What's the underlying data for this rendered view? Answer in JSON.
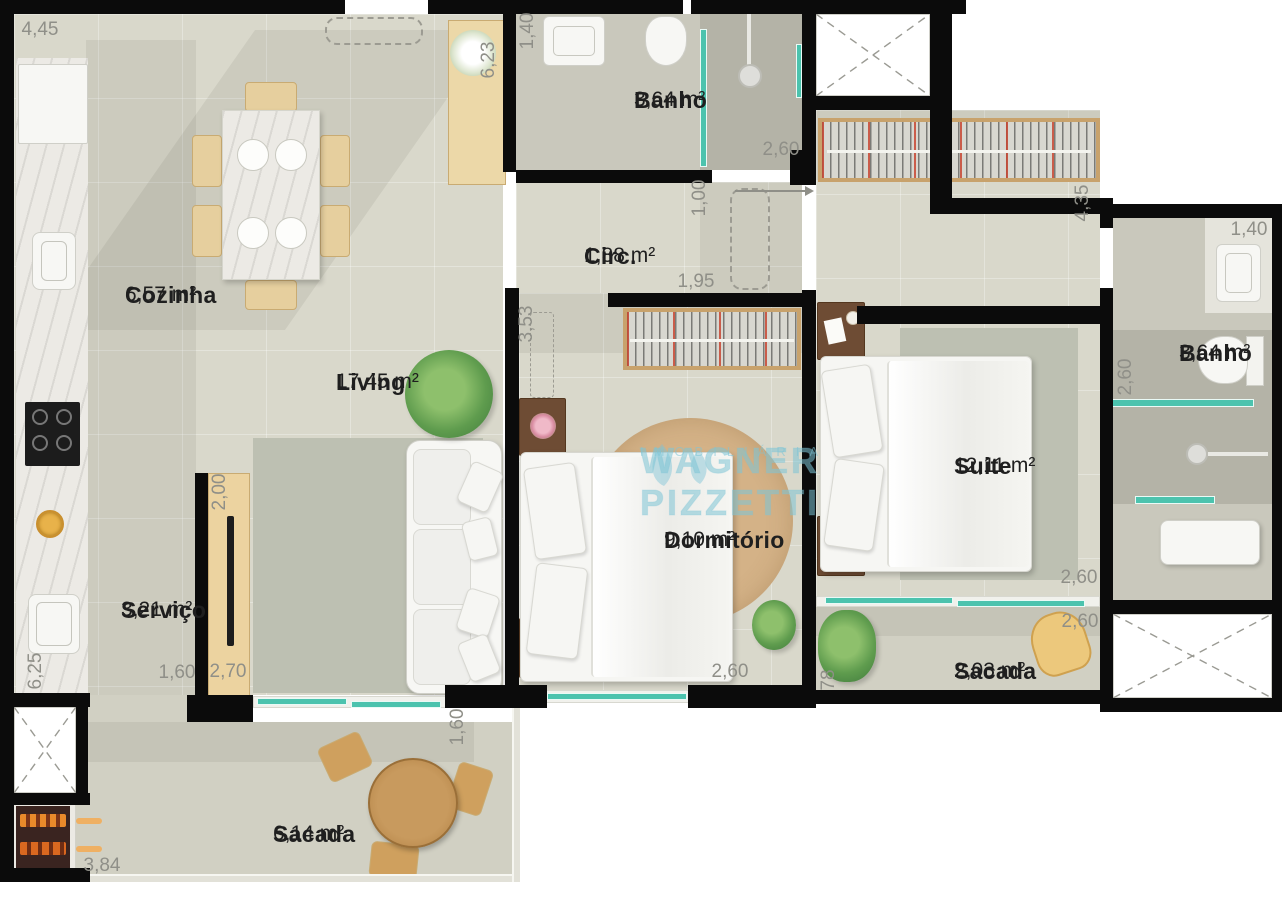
{
  "plan": {
    "type": "apartment-floor-plan",
    "rooms": [
      {
        "id": "cozinha",
        "name": "Cozinha",
        "area": "6,57 m²"
      },
      {
        "id": "banho-social",
        "name": "Banho",
        "area": "3,64 m²"
      },
      {
        "id": "circulacao",
        "name": "Circ.",
        "area": "1,88 m²"
      },
      {
        "id": "living",
        "name": "Living",
        "area": "17,45 m²"
      },
      {
        "id": "dormitorio",
        "name": "Dormitório",
        "area": "9,10 m²"
      },
      {
        "id": "suite",
        "name": "Suite",
        "area": "12,11 m²"
      },
      {
        "id": "banho-suite",
        "name": "Banho",
        "area": "3,64 m²"
      },
      {
        "id": "servico",
        "name": "Serviço",
        "area": "3,21 m²"
      },
      {
        "id": "sacada-suite",
        "name": "Sacada",
        "area": "2,03 m²"
      },
      {
        "id": "sacada-living",
        "name": "Sacada",
        "area": "6,14 m²"
      }
    ],
    "dims": [
      "4,45",
      "1,40",
      "6,23",
      "2,60",
      "1,00",
      "1,95",
      "4,35",
      "1,40",
      "3,53",
      "2,00",
      "1,60",
      "2,70",
      "6,25",
      "2,60",
      "1,60",
      "2,60",
      "2,60",
      "2,60",
      "78",
      "3,84"
    ],
    "watermark": {
      "line1": "WAGNER PIZZETTI",
      "line2": "IMOBILIÁRIA"
    },
    "colors": {
      "wall": "#0b0b0b",
      "floor_main": "#d9d8cb",
      "floor_wet": "#c9c8bc",
      "floor_shower": "#b4b3a7",
      "floor_balcony": "#d1d0c3",
      "glass": "#4cc3ae",
      "wood_light": "#e6cf9e",
      "wood_dark": "#6e4c34",
      "marble": "#eceae5",
      "rug_gray": "#bdc0b2",
      "rug_round": "#d4b287",
      "label_text": "#1f1f1f",
      "dimension_text": "#8f8f88",
      "watermark_blue": "#7dc4d6"
    }
  }
}
